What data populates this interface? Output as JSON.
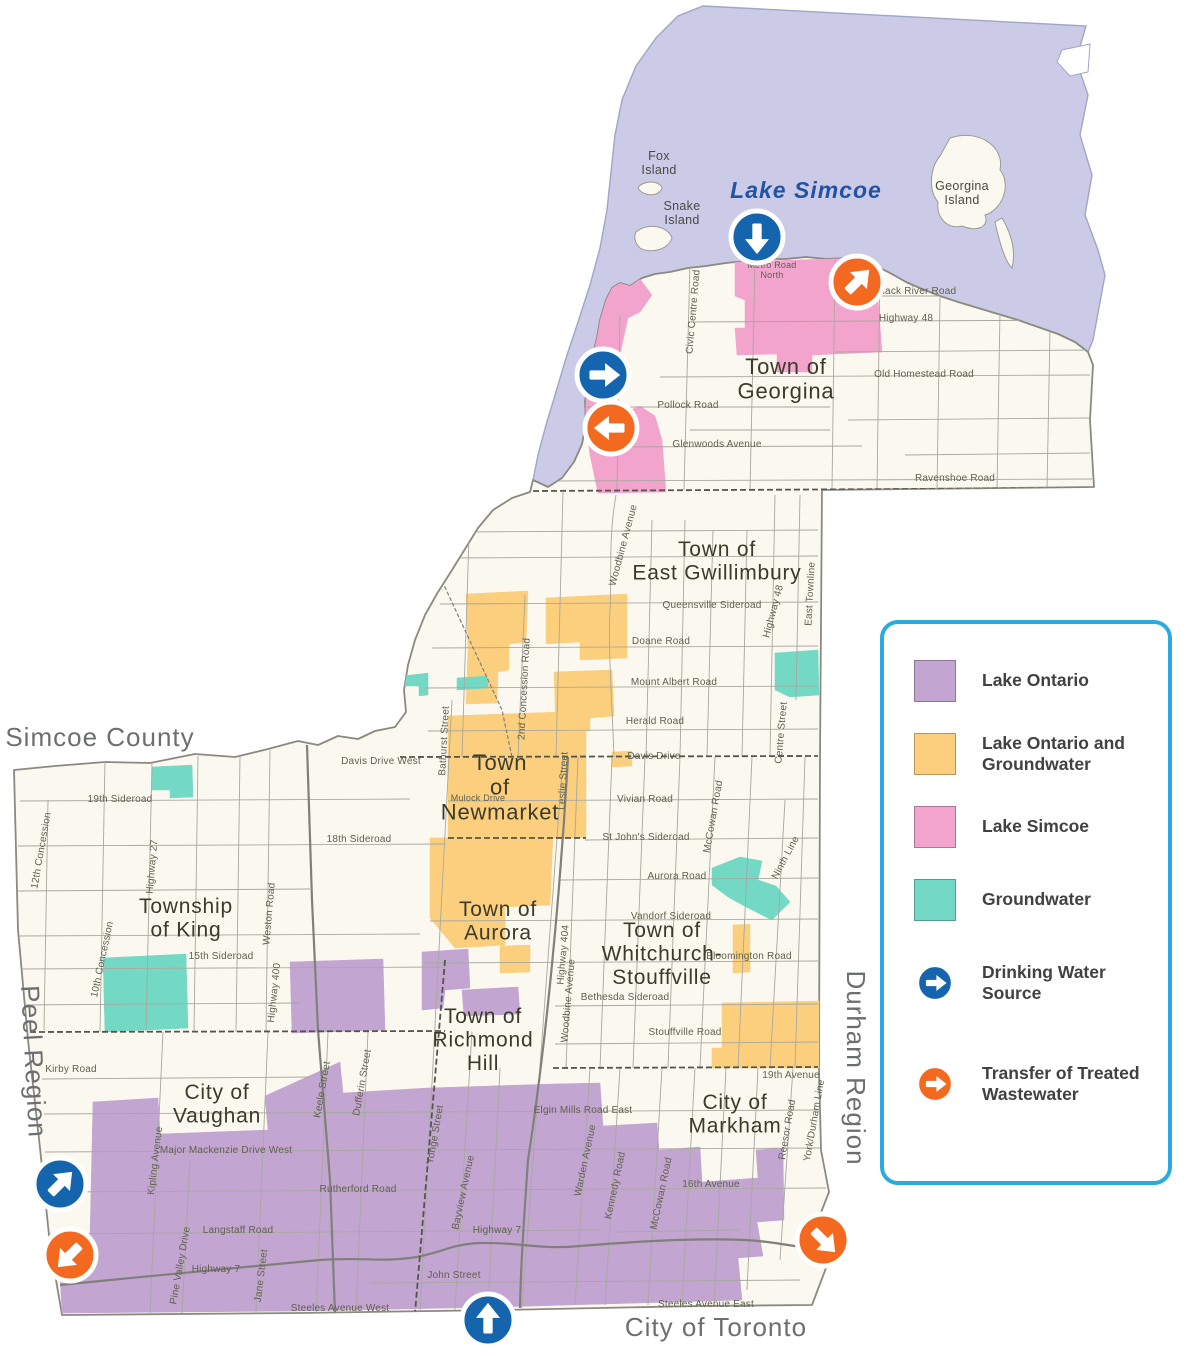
{
  "colors": {
    "water": "#CBCAE7",
    "land": "#FAF8EF",
    "lake_ontario": "#C3A5D1",
    "lake_ontario_groundwater": "#FBCF7D",
    "lake_simcoe": "#F2A4CC",
    "groundwater": "#73D9C5",
    "drinking": "#1565AE",
    "wastewater": "#F2691F",
    "legend_border": "#29ABE2",
    "road": "#A8A8A0",
    "major_road": "#80807A",
    "boundary": "#55554D",
    "outline": "#8A8A80",
    "town_text": "#3B3B2A",
    "road_text": "#60604F",
    "outside_text": "#6D6E71",
    "water_text": "#2353A3"
  },
  "legend": {
    "items": [
      {
        "type": "swatch",
        "color_key": "lake_ontario",
        "lines": [
          "Lake Ontario"
        ],
        "name": "lake-ontario"
      },
      {
        "type": "swatch",
        "color_key": "lake_ontario_groundwater",
        "lines": [
          "Lake Ontario and",
          "Groundwater"
        ],
        "name": "lake-ontario-and-groundwater"
      },
      {
        "type": "swatch",
        "color_key": "lake_simcoe",
        "lines": [
          "Lake Simcoe"
        ],
        "name": "lake-simcoe"
      },
      {
        "type": "swatch",
        "color_key": "groundwater",
        "lines": [
          "Groundwater"
        ],
        "name": "groundwater"
      },
      {
        "type": "arrow",
        "color_key": "drinking",
        "lines": [
          "Drinking Water",
          "Source"
        ],
        "name": "drinking-water-source"
      },
      {
        "type": "arrow",
        "color_key": "wastewater",
        "lines": [
          "Transfer of Treated",
          "Wastewater"
        ],
        "name": "transfer-of-treated-wastewater"
      }
    ]
  },
  "map": {
    "water_labels": [
      {
        "t": "Lake Simcoe",
        "x": 806,
        "y": 198,
        "s": 23
      }
    ],
    "island_labels": [
      {
        "lines": [
          "Fox",
          "Island"
        ],
        "x": 659,
        "y": 160,
        "s": 12.5
      },
      {
        "lines": [
          "Snake",
          "Island"
        ],
        "x": 682,
        "y": 210,
        "s": 12.5
      },
      {
        "lines": [
          "Georgina",
          "Island"
        ],
        "x": 962,
        "y": 190,
        "s": 12.5
      }
    ],
    "municipality_labels": [
      {
        "lines": [
          "Town of",
          "Georgina"
        ],
        "x": 786,
        "y": 374,
        "s": 22
      },
      {
        "lines": [
          "Town of",
          "East Gwillimbury"
        ],
        "x": 717,
        "y": 556,
        "s": 21
      },
      {
        "lines": [
          "Town",
          "of",
          "Newmarket"
        ],
        "x": 500,
        "y": 770,
        "s": 22
      },
      {
        "lines": [
          "Town of",
          "Aurora"
        ],
        "x": 498,
        "y": 916,
        "s": 21
      },
      {
        "lines": [
          "Township",
          "of King"
        ],
        "x": 186,
        "y": 913,
        "s": 21
      },
      {
        "lines": [
          "Town of",
          "Whitchurch-",
          "Stouffville"
        ],
        "x": 662,
        "y": 937,
        "s": 21
      },
      {
        "lines": [
          "Town of",
          "Richmond",
          "Hill"
        ],
        "x": 483,
        "y": 1023,
        "s": 21
      },
      {
        "lines": [
          "City of",
          "Vaughan"
        ],
        "x": 217,
        "y": 1099,
        "s": 21
      },
      {
        "lines": [
          "City of",
          "Markham"
        ],
        "x": 735,
        "y": 1109,
        "s": 21
      }
    ],
    "outside_labels": [
      {
        "t": "Simcoe County",
        "x": 100,
        "y": 746,
        "s": 26
      },
      {
        "t": "City of Toronto",
        "x": 716,
        "y": 1336,
        "s": 26
      },
      {
        "t": "Peel Region",
        "x": 25,
        "y": 1062,
        "s": 26,
        "r": 87
      },
      {
        "t": "Durham Region",
        "x": 847,
        "y": 1068,
        "s": 26,
        "r": 90
      }
    ],
    "road_labels": [
      {
        "lines": [
          "Metro Road",
          "North"
        ],
        "x": 772,
        "y": 268,
        "s": 9
      },
      {
        "t": "Black River Road",
        "x": 916,
        "y": 294
      },
      {
        "t": "Highway 48",
        "x": 906,
        "y": 321
      },
      {
        "t": "Old Homestead Road",
        "x": 924,
        "y": 377
      },
      {
        "t": "Pollock Road",
        "x": 688,
        "y": 408
      },
      {
        "t": "Glenwoods Avenue",
        "x": 717,
        "y": 447
      },
      {
        "t": "Ravenshoe Road",
        "x": 955,
        "y": 481
      },
      {
        "t": "Civic Centre Road",
        "x": 696,
        "y": 312,
        "r": -85
      },
      {
        "t": "Woodbine Avenue",
        "x": 626,
        "y": 546,
        "r": -75
      },
      {
        "t": "Queensville Sideroad",
        "x": 712,
        "y": 608
      },
      {
        "t": "Doane Road",
        "x": 661,
        "y": 644
      },
      {
        "t": "Mount Albert Road",
        "x": 674,
        "y": 685
      },
      {
        "t": "Herald Road",
        "x": 655,
        "y": 724
      },
      {
        "t": "Davis Drive",
        "x": 654,
        "y": 759
      },
      {
        "t": "Highway 48",
        "x": 776,
        "y": 612,
        "r": -75
      },
      {
        "t": "East Townline",
        "x": 813,
        "y": 594,
        "r": -87
      },
      {
        "t": "Centre Street",
        "x": 784,
        "y": 733,
        "r": -85
      },
      {
        "t": "2nd Concession Road",
        "x": 527,
        "y": 689,
        "r": -87
      },
      {
        "t": "Bathurst Street",
        "x": 447,
        "y": 741,
        "r": -87
      },
      {
        "t": "Mulock Drive",
        "x": 478,
        "y": 801,
        "s": 9
      },
      {
        "t": "Leslie Street",
        "x": 566,
        "y": 781,
        "r": -87
      },
      {
        "t": "Davis Drive West",
        "x": 381,
        "y": 764
      },
      {
        "t": "Vivian Road",
        "x": 645,
        "y": 802
      },
      {
        "t": "St John's Sideroad",
        "x": 646,
        "y": 840
      },
      {
        "t": "Aurora Road",
        "x": 677,
        "y": 879
      },
      {
        "t": "Vandorf Sideroad",
        "x": 671,
        "y": 919
      },
      {
        "t": "Bloomington Road",
        "x": 749,
        "y": 959
      },
      {
        "t": "Bethesda Sideroad",
        "x": 625,
        "y": 1000
      },
      {
        "t": "Stouffville Road",
        "x": 685,
        "y": 1035
      },
      {
        "t": "19th Avenue",
        "x": 791,
        "y": 1078
      },
      {
        "t": "McCowan Road",
        "x": 716,
        "y": 817,
        "r": -80
      },
      {
        "t": "Ninth Line",
        "x": 788,
        "y": 859,
        "r": -62
      },
      {
        "t": "Highway 404",
        "x": 566,
        "y": 955,
        "r": -85
      },
      {
        "t": "Woodbine Avenue",
        "x": 571,
        "y": 1001,
        "r": -85
      },
      {
        "t": "19th Sideroad",
        "x": 120,
        "y": 802
      },
      {
        "t": "18th Sideroad",
        "x": 359,
        "y": 842
      },
      {
        "t": "15th Sideroad",
        "x": 221,
        "y": 959
      },
      {
        "t": "Kirby Road",
        "x": 71,
        "y": 1072
      },
      {
        "t": "12th Concession",
        "x": 44,
        "y": 851,
        "r": -80
      },
      {
        "t": "10th Concession",
        "x": 105,
        "y": 960,
        "r": -78
      },
      {
        "t": "Highway 27",
        "x": 155,
        "y": 867,
        "r": -85
      },
      {
        "t": "Weston Road",
        "x": 272,
        "y": 914,
        "r": -85
      },
      {
        "t": "Highway 400",
        "x": 277,
        "y": 993,
        "r": -84
      },
      {
        "t": "Major Mackenzie Drive West",
        "x": 226,
        "y": 1153
      },
      {
        "t": "Rutherford Road",
        "x": 358,
        "y": 1192
      },
      {
        "t": "Langstaff Road",
        "x": 238,
        "y": 1233
      },
      {
        "t": "Highway 7",
        "x": 216,
        "y": 1272
      },
      {
        "t": "Highway 7",
        "x": 497,
        "y": 1233
      },
      {
        "t": "Steeles Avenue West",
        "x": 340,
        "y": 1311
      },
      {
        "t": "John Street",
        "x": 454,
        "y": 1278
      },
      {
        "t": "Kipling Avenue",
        "x": 158,
        "y": 1161,
        "r": -83
      },
      {
        "t": "Pine Valley Drive",
        "x": 183,
        "y": 1266,
        "r": -80
      },
      {
        "t": "Jane Street",
        "x": 264,
        "y": 1276,
        "r": -83
      },
      {
        "t": "Keele Street",
        "x": 325,
        "y": 1090,
        "r": -80
      },
      {
        "t": "Dufferin Street",
        "x": 365,
        "y": 1083,
        "r": -80
      },
      {
        "t": "Yonge Street",
        "x": 438,
        "y": 1135,
        "r": -80
      },
      {
        "t": "Bayview Avenue",
        "x": 466,
        "y": 1193,
        "r": -78
      },
      {
        "t": "Elgin Mills Road East",
        "x": 583,
        "y": 1113
      },
      {
        "t": "16th Avenue",
        "x": 711,
        "y": 1187
      },
      {
        "t": "Steeles Avenue East",
        "x": 706,
        "y": 1307
      },
      {
        "t": "Warden Avenue",
        "x": 588,
        "y": 1161,
        "r": -78
      },
      {
        "t": "Kennedy Road",
        "x": 618,
        "y": 1186,
        "r": -78
      },
      {
        "t": "McCowan Road",
        "x": 664,
        "y": 1194,
        "r": -78
      },
      {
        "t": "Reesor Road",
        "x": 790,
        "y": 1130,
        "r": -80
      },
      {
        "t": "York/Durham Line",
        "x": 817,
        "y": 1121,
        "r": -80
      }
    ],
    "arrows": [
      {
        "kind": "drinking",
        "x": 757,
        "y": 237,
        "angle": 90
      },
      {
        "kind": "wastewater",
        "x": 857,
        "y": 282,
        "angle": 315
      },
      {
        "kind": "drinking",
        "x": 603,
        "y": 375,
        "angle": 0
      },
      {
        "kind": "wastewater",
        "x": 611,
        "y": 428,
        "angle": 180
      },
      {
        "kind": "drinking",
        "x": 60,
        "y": 1184,
        "angle": 315
      },
      {
        "kind": "wastewater",
        "x": 70,
        "y": 1255,
        "angle": 135
      },
      {
        "kind": "drinking",
        "x": 488,
        "y": 1320,
        "angle": 270
      },
      {
        "kind": "wastewater",
        "x": 823,
        "y": 1240,
        "angle": 45
      }
    ]
  }
}
